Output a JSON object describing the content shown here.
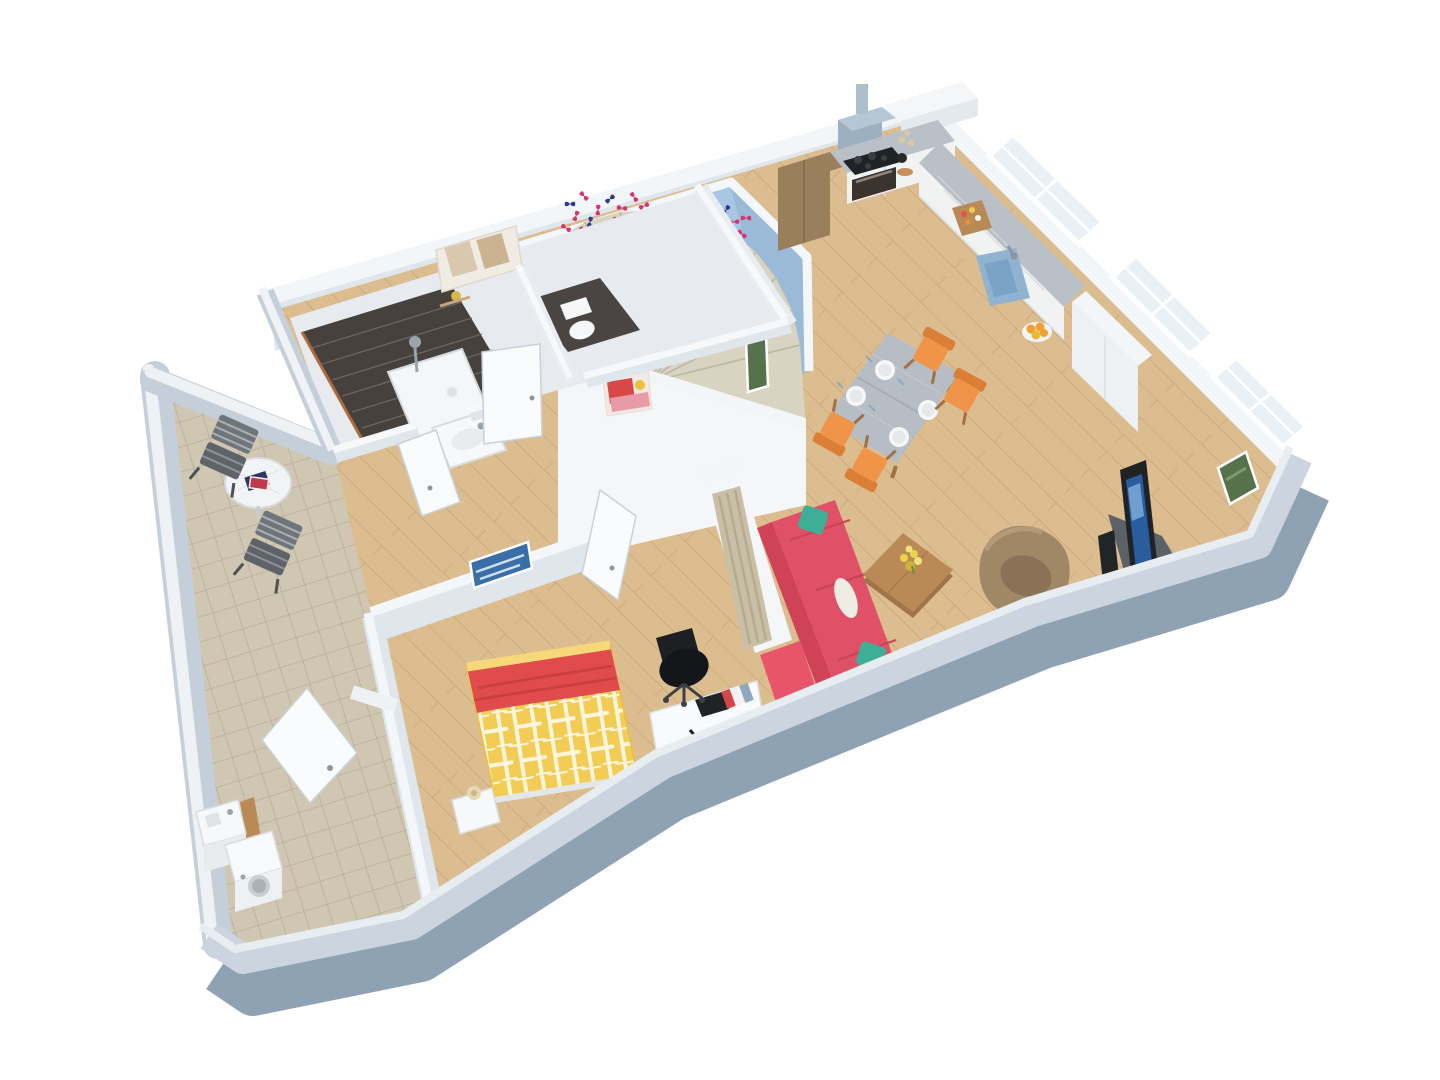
{
  "scene": {
    "kind": "3d-rendered-floor-plan",
    "background": "#ffffff",
    "rooms": [
      "kitchen",
      "dining-area",
      "living-room",
      "bedroom",
      "bathroom",
      "wc",
      "staircase",
      "hallway",
      "terrace",
      "laundry"
    ],
    "furniture": {
      "kitchen": [
        "range-hood",
        "cooktop",
        "oven",
        "tall-brown-cabinet",
        "upper-cabinets",
        "counter",
        "blue-sink",
        "cutting-board",
        "fruit-bowl",
        "tall-white-unit"
      ],
      "dining-area": [
        "gray-wood-table",
        "four-plates",
        "orange-chair",
        "orange-chair",
        "orange-chair",
        "orange-chair"
      ],
      "living-room": [
        "red-sofa",
        "teal-pillows",
        "white-roll-pillow",
        "red-bench",
        "coffee-table",
        "flower-vase",
        "tan-armchair",
        "tv",
        "tv-corner-stand",
        "green-wall-picture"
      ],
      "bedroom": [
        "yellow-bed",
        "red-blanket",
        "nightstand",
        "table-lamp",
        "white-desk",
        "black-office-chair",
        "desk-lamp",
        "books",
        "blue-wall-picture",
        "curtain-divider"
      ],
      "bathroom": [
        "dark-tiled-shower",
        "shower-tray",
        "shower-fixture",
        "washbasin",
        "wall-shelf-decor"
      ],
      "wc": [
        "toilet"
      ],
      "staircase": [
        "winder-stairs",
        "butterfly-decals",
        "green-picture",
        "red-poster"
      ],
      "terrace": [
        "round-table",
        "magazines",
        "folding-chair",
        "folding-chair"
      ],
      "laundry": [
        "washing-machine",
        "utility-sink"
      ]
    }
  },
  "palette": {
    "wall_top": "#f3f6f8",
    "wall_face": "#dfe6ec",
    "wall_band": "#ccd5df",
    "wall_dark": "#8ea2b4",
    "wall_outer": "#c5cfd9",
    "wall_blue": "#a9c7e2",
    "wall_blue2": "#9bbad8",
    "stairs": "#d9d3c1",
    "shower": "#46413c",
    "sofa": "#e05066",
    "sofa2": "#cf4257",
    "pillow": "#3fae96",
    "bench": "#e8556a",
    "orange": "#ef9449",
    "orange2": "#da7f35",
    "tableg": "#b7bdc4",
    "wood": "#b98a55",
    "wood2": "#9e7244",
    "bed": "#f2cc55",
    "blanket": "#e04b4b",
    "arm": "#a08766",
    "arm2": "#8a7257",
    "tv": "#202326",
    "screen": "#2a5d9e",
    "ctop": "#b9c0c7",
    "cab": "#f1f2f2",
    "sink": "#8fb3d1",
    "hood": "#9db0c0",
    "cabbr": "#9a7f5c",
    "curtain": "#c8bfa6",
    "chairg": "#6e757b",
    "picgreen": "#55724c",
    "picblue": "#3a6ea8",
    "poster": "#d84848",
    "butterfly_pink": "#d6356f",
    "butterfly_navy": "#2f3a8f",
    "floor_wood": "#dcbd90",
    "floor_wood_line": "#cdab7c",
    "floor_tile": "#cfc7b1",
    "floor_tile_line": "#b7af99"
  }
}
